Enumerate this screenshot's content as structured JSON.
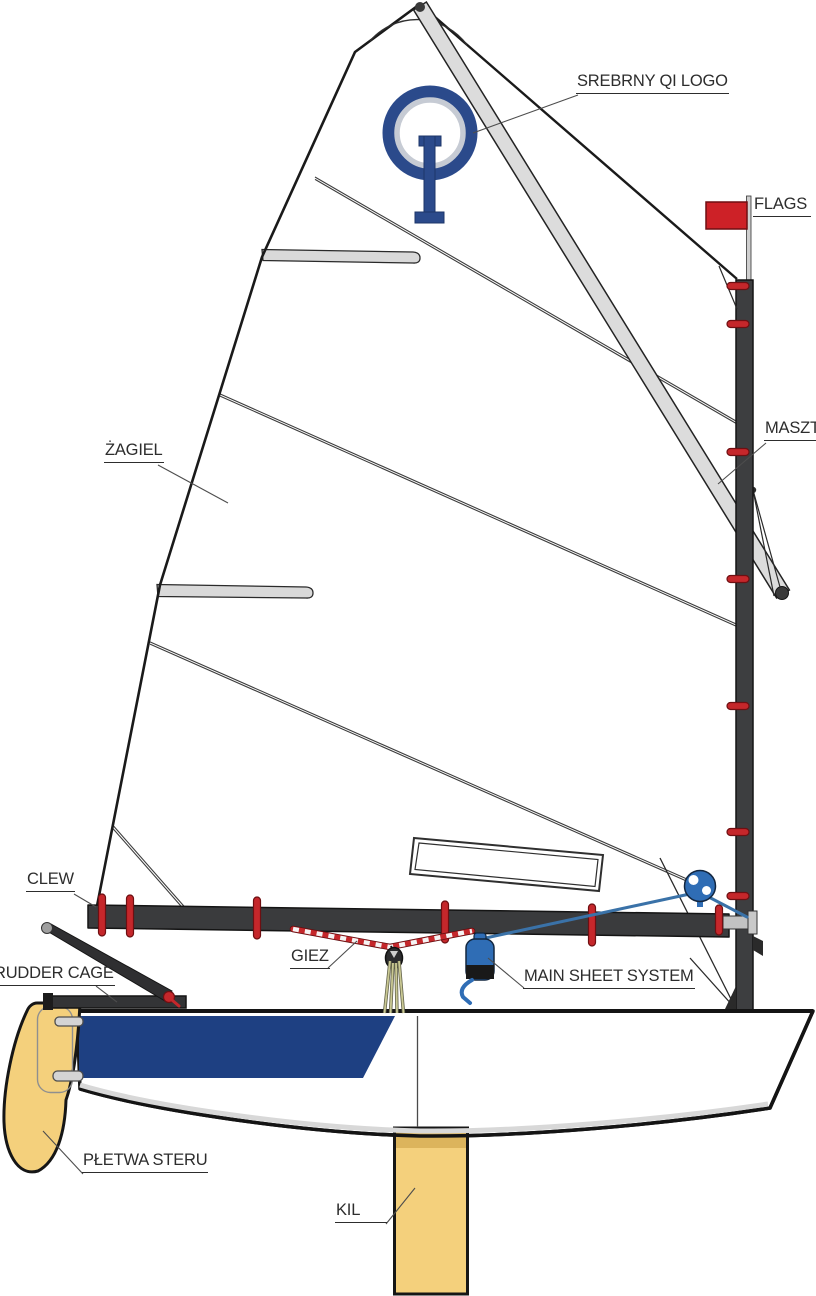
{
  "diagram": {
    "labels": {
      "logo": "SREBRNY QI LOGO",
      "flags": "FLAGS",
      "mast": "MASZT",
      "sail": "ŻAGIEL",
      "clew": "CLEW",
      "giez": "GIEZ",
      "main_sheet_system": "MAIN SHEET SYSTEM",
      "rudder_cage": "RUDDER CAGE",
      "rudder_blade": "PŁETWA STERU",
      "keel": "KIL"
    },
    "colors": {
      "outline": "#1a1a1a",
      "label": "#2d2d2d",
      "mast": "#3d3e40",
      "boom": "#3a3b3d",
      "sprit": "#dcdcdc",
      "sail": "#ffffff",
      "tie-red": "#c5272b",
      "flag-red": "#cd2127",
      "logo-navy": "#2b4a8b",
      "logo-silver": "#c6cbd4",
      "hull-blue": "#1e4082",
      "board-yellow": "#f4d07c",
      "board-shade": "#dcb45c",
      "hardware-blue": "#2f6db5",
      "sheet-blue": "#3a72a8",
      "tackle-yellow": "#c9c893",
      "fitting-gray": "#c2c2c2"
    }
  }
}
